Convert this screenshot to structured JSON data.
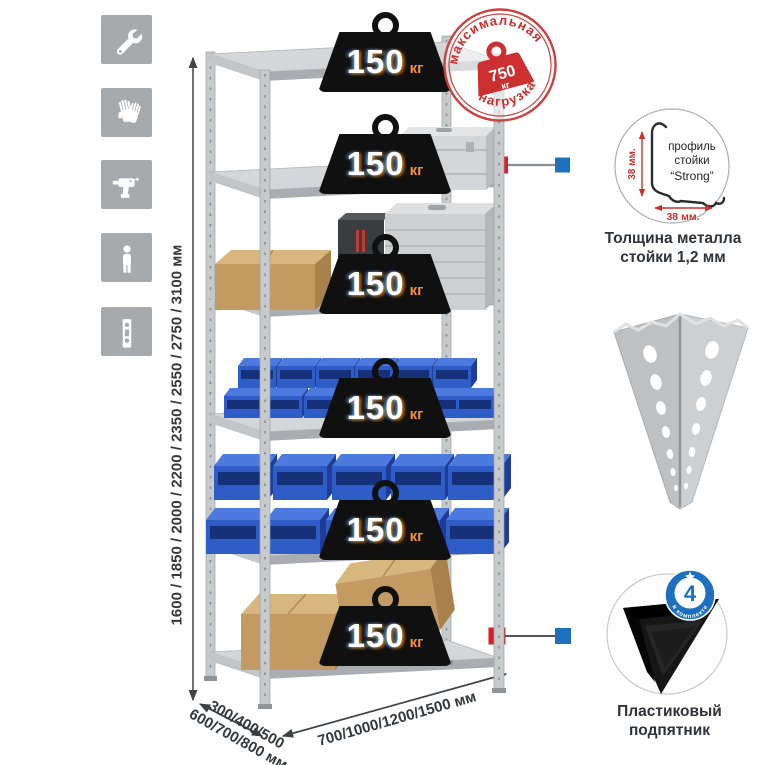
{
  "sidebar": {
    "icons": [
      {
        "name": "wrench-icon"
      },
      {
        "name": "gloves-icon"
      },
      {
        "name": "drill-icon"
      },
      {
        "name": "person-icon"
      },
      {
        "name": "level-icon"
      }
    ]
  },
  "rack": {
    "height_options": "1600 / 1850 / 2000 / 2200 / 2350 / 2550 / 2750 / 3100 мм",
    "depth_options_line1": "300/400/500",
    "depth_options_line2": "600/700/800 мм",
    "width_options": "700/1000/1200/1500 мм",
    "shelf_load_value": "150",
    "shelf_load_unit": "кг",
    "shelf_count": 6
  },
  "max_load_stamp": {
    "arc_top": "максимальная",
    "arc_bottom": "нагрузка",
    "value": "750",
    "unit": "кг"
  },
  "profile_detail": {
    "label_line1": "профиль",
    "label_line2": "стойки",
    "label_line3": "“Strong”",
    "dim_vertical": "38 мм.",
    "dim_horizontal": "38 мм.",
    "caption_line1": "Толщина металла",
    "caption_line2": "стойки 1,2 мм"
  },
  "foot_detail": {
    "badge_value": "4",
    "badge_arc": "в комплекте",
    "caption_line1": "Пластиковый",
    "caption_line2": "подпятник"
  },
  "colors": {
    "accent_red": "#cc2f2f",
    "marker_red": "#d62127",
    "marker_blue": "#1d6fc0",
    "bin_blue": "#2e5dc8",
    "tile_gray": "#a6aaad"
  }
}
